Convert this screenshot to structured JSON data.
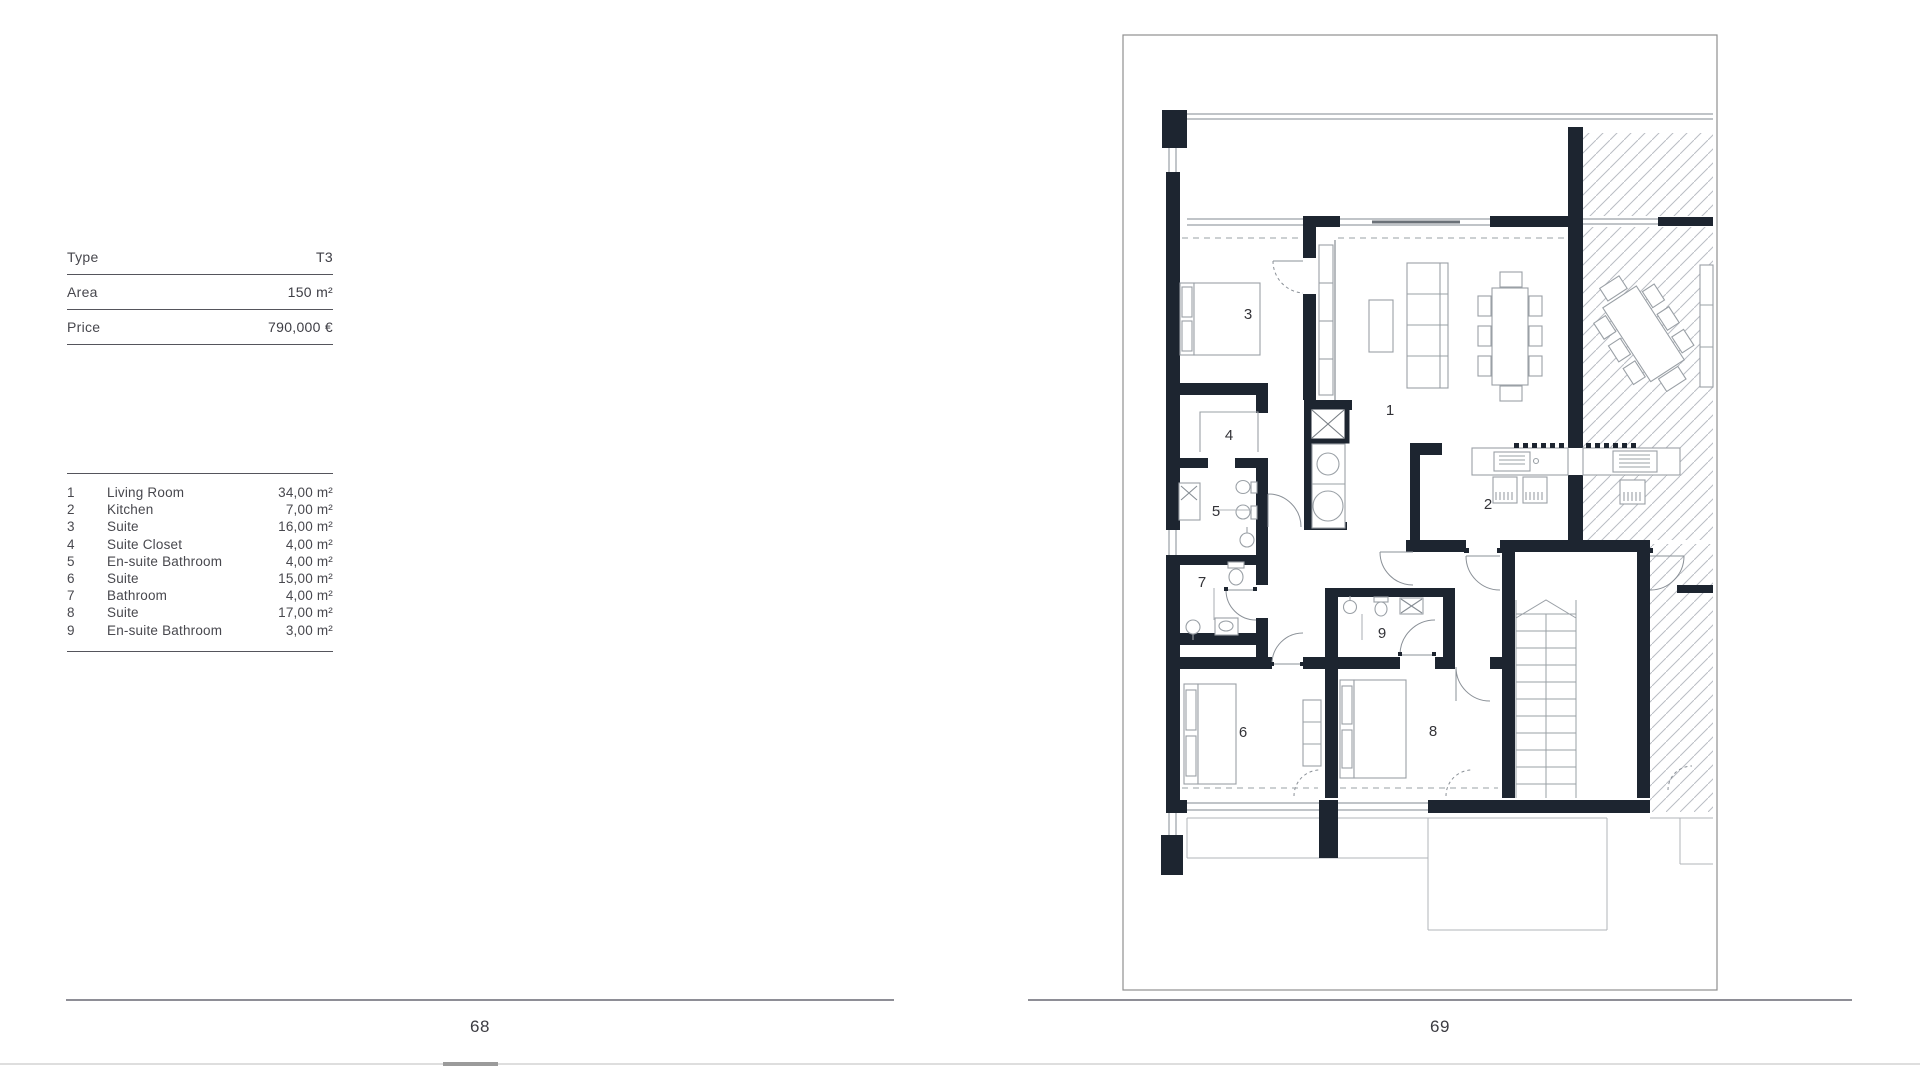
{
  "left_page": {
    "spec_table": {
      "rows": [
        {
          "label": "Type",
          "value": "T3"
        },
        {
          "label": "Area",
          "value": "150 m²"
        },
        {
          "label": "Price",
          "value": "790,000 €"
        }
      ]
    },
    "room_table": {
      "rows": [
        {
          "num": "1",
          "name": "Living Room",
          "area": "34,00 m²"
        },
        {
          "num": "2",
          "name": "Kitchen",
          "area": "7,00 m²"
        },
        {
          "num": "3",
          "name": "Suite",
          "area": "16,00 m²"
        },
        {
          "num": "4",
          "name": "Suite Closet",
          "area": "4,00 m²"
        },
        {
          "num": "5",
          "name": "En-suite Bathroom",
          "area": "4,00 m²"
        },
        {
          "num": "6",
          "name": "Suite",
          "area": "15,00 m²"
        },
        {
          "num": "7",
          "name": "Bathroom",
          "area": "4,00 m²"
        },
        {
          "num": "8",
          "name": "Suite",
          "area": "17,00 m²"
        },
        {
          "num": "9",
          "name": "En-suite Bathroom",
          "area": "3,00 m²"
        }
      ]
    },
    "page_number": "68"
  },
  "right_page": {
    "page_number": "69",
    "floorplan": {
      "room_labels": [
        {
          "id": "1",
          "x": 1390,
          "y": 415
        },
        {
          "id": "2",
          "x": 1488,
          "y": 509
        },
        {
          "id": "3",
          "x": 1248,
          "y": 319
        },
        {
          "id": "4",
          "x": 1229,
          "y": 440
        },
        {
          "id": "5",
          "x": 1216,
          "y": 516
        },
        {
          "id": "6",
          "x": 1243,
          "y": 737
        },
        {
          "id": "7",
          "x": 1202,
          "y": 587
        },
        {
          "id": "8",
          "x": 1433,
          "y": 736
        },
        {
          "id": "9",
          "x": 1382,
          "y": 638
        }
      ]
    }
  },
  "colors": {
    "wall": "#1d2530",
    "thin_line": "#9aa0a6",
    "hatch": "#b9bdc4",
    "text": "#46464c",
    "rule": "#55555c",
    "footer_rule": "#8e8e96"
  }
}
